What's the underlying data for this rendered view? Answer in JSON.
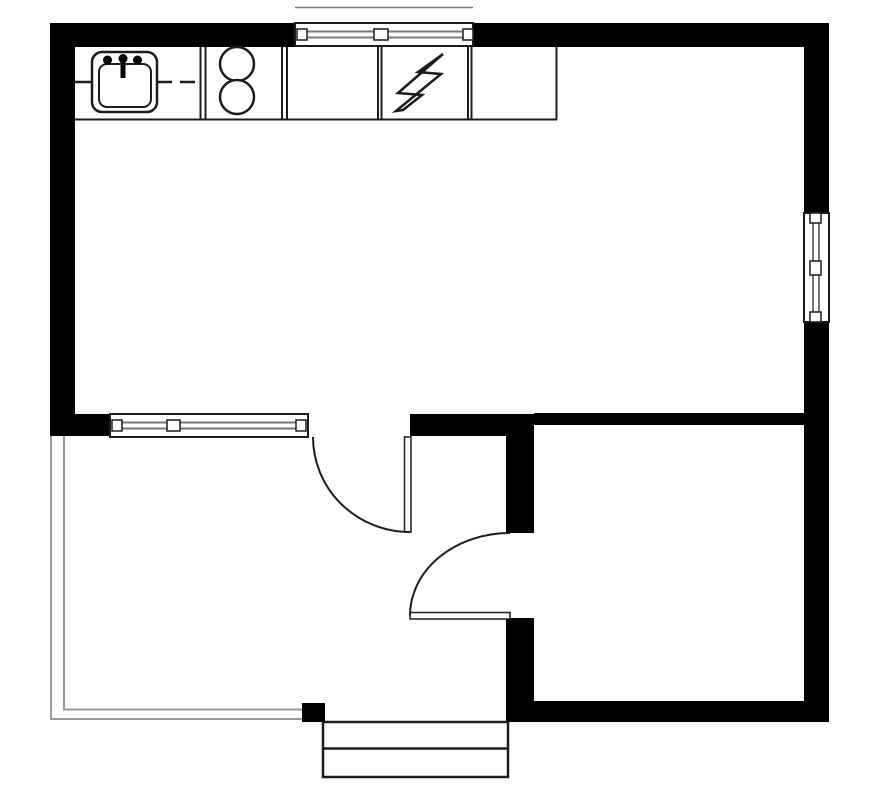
{
  "meta": {
    "title": "One-bedroom floor plan with kitchen counter, porch and entry steps",
    "canvas": {
      "width": 875,
      "height": 800
    }
  },
  "colors": {
    "bg": "#ffffff",
    "wall": "#000000",
    "line": "#1c1c1c",
    "glaze": "#777777",
    "porch": "#9a9a9a"
  },
  "floor_plan": {
    "rooms": [
      {
        "name": "main-room",
        "description": "large open living / kitchen room, upper area"
      },
      {
        "name": "bedroom",
        "description": "lower-right room enclosed by thick walls"
      },
      {
        "name": "porch",
        "description": "lower-left open deck bounded by thin double lines"
      },
      {
        "name": "entry",
        "description": "recessed entry landing between porch and bedroom"
      }
    ],
    "kitchen_counter": {
      "cells": 5,
      "contents": [
        "sink",
        "two-burner stove",
        "empty",
        "electrical panel",
        "empty"
      ]
    },
    "fixtures": [
      {
        "name": "kitchen-sink",
        "icon": "sink-icon"
      },
      {
        "name": "stove-burners",
        "icon": "two-circles-icon"
      },
      {
        "name": "electrical-panel",
        "icon": "lightning-bolt-icon"
      }
    ],
    "windows": [
      {
        "name": "top-window",
        "wall": "north",
        "panes": 2
      },
      {
        "name": "right-window",
        "wall": "east",
        "panes": 2
      },
      {
        "name": "middle-window",
        "wall": "between main room and porch",
        "panes": 2
      }
    ],
    "doors": [
      {
        "name": "main-room-door",
        "type": "swing",
        "arc": "quarter-circle"
      },
      {
        "name": "bedroom-door",
        "type": "swing",
        "arc": "quarter-circle"
      }
    ],
    "steps": {
      "count": 2,
      "location": "bottom entry"
    }
  }
}
